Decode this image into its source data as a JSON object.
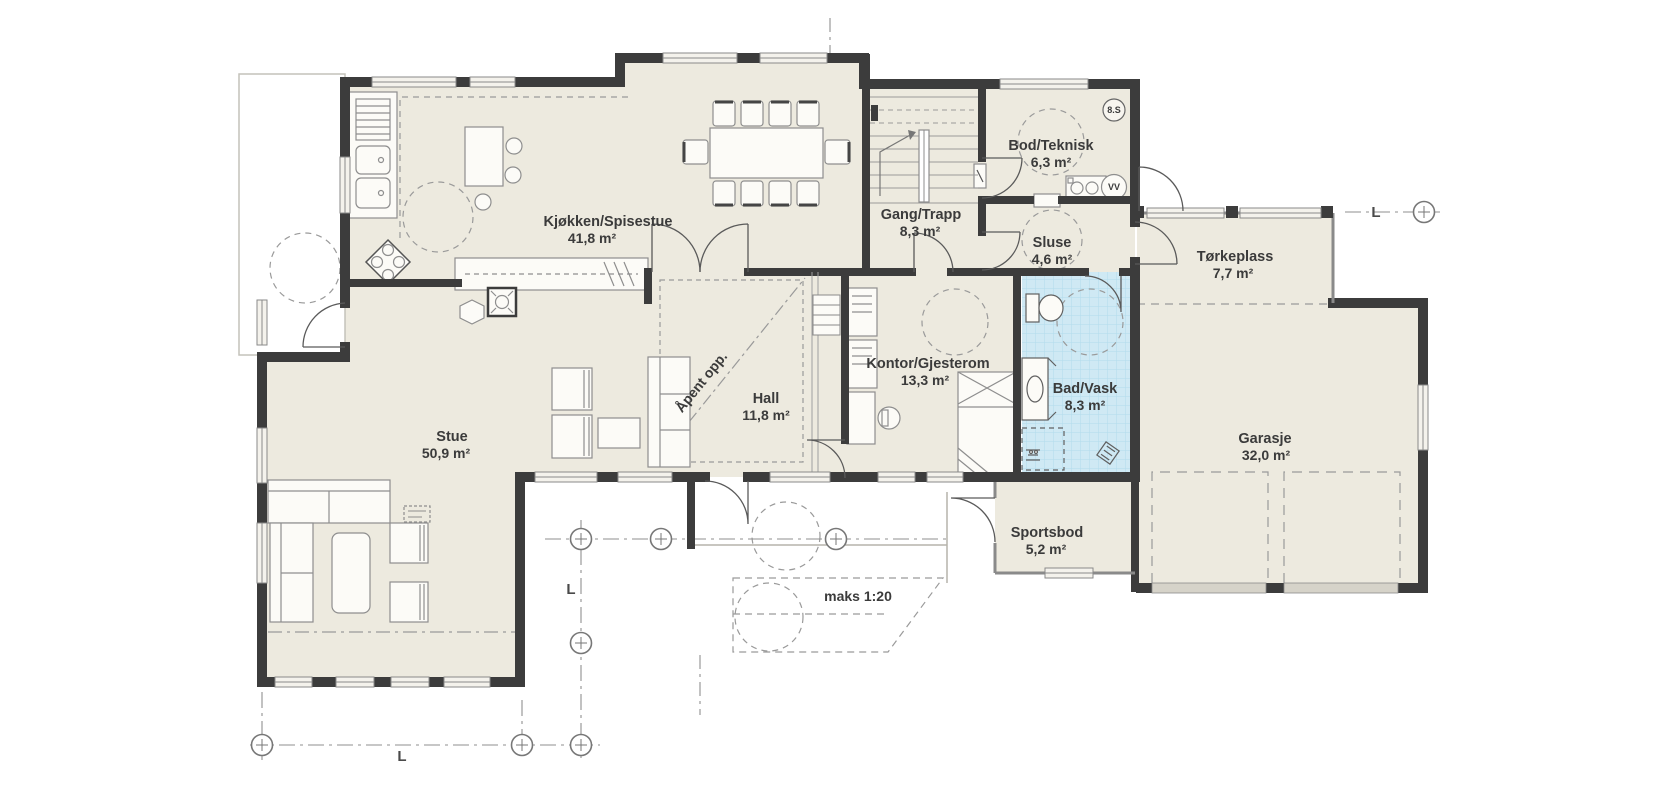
{
  "plan": {
    "type": "floor-plan",
    "rooms": {
      "kjokken": {
        "name": "Kjøkken/Spisestue",
        "area": "41,8 m²"
      },
      "gang": {
        "name": "Gang/Trapp",
        "area": "8,3 m²"
      },
      "bod": {
        "name": "Bod/Teknisk",
        "area": "6,3 m²"
      },
      "sluse": {
        "name": "Sluse",
        "area": "4,6 m²"
      },
      "torkeplass": {
        "name": "Tørkeplass",
        "area": "7,7 m²"
      },
      "hall": {
        "name": "Hall",
        "area": "11,8 m²"
      },
      "kontor": {
        "name": "Kontor/Gjesterom",
        "area": "13,3 m²"
      },
      "bad": {
        "name": "Bad/Vask",
        "area": "8,3 m²"
      },
      "stue": {
        "name": "Stue",
        "area": "50,9 m²"
      },
      "garasje": {
        "name": "Garasje",
        "area": "32,0 m²"
      },
      "sportsbod": {
        "name": "Sportsbod",
        "area": "5,2 m²"
      }
    },
    "annotations": {
      "open_above": "Åpent opp.",
      "ramp_slope": "maks 1:20",
      "section_badge": "8.S",
      "water_heater": "VV",
      "grid_label": "L"
    },
    "colors": {
      "background": "#ffffff",
      "floor": "#edeadf",
      "wall": "#3c3c3c",
      "bath_tile": "#cfe9f4",
      "bath_tile_line": "#b2dcec",
      "drawing_line": "#8a8a8a"
    }
  }
}
